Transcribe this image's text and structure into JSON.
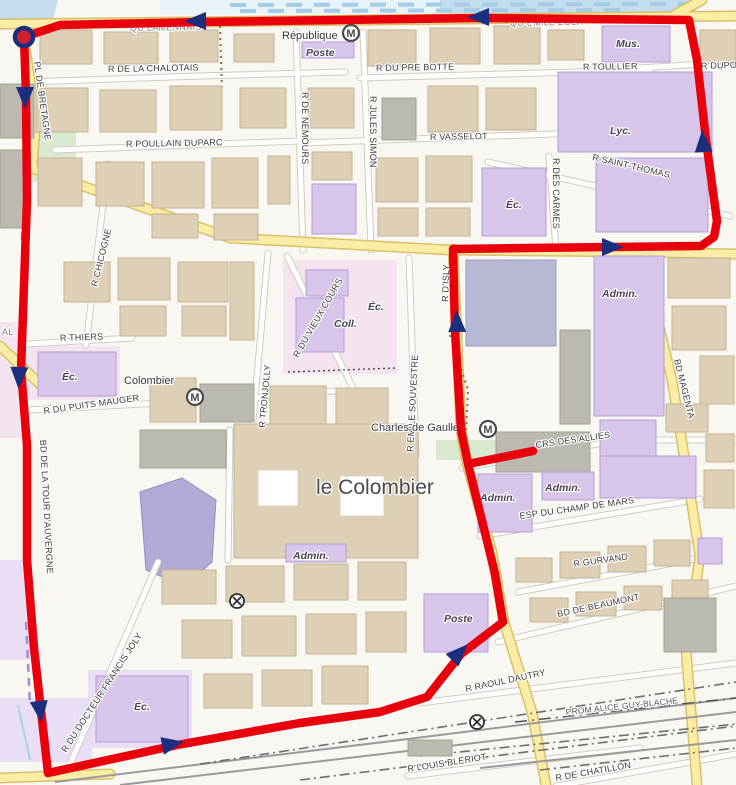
{
  "colors": {
    "route": "#e8000d",
    "arrow": "#1b2f7e",
    "marker_fill": "#d21f2e",
    "water": "#c3dcee",
    "road_yellow": "#fbeda5",
    "building_public": "#d7c6ea"
  },
  "route": {
    "main_points": "533,451 468,464 461,430 455,330 453,249 610,247 701,246 714,237 717,221 706,140 697,60 689,20 480,18 200,22 60,25 24,37 26,95 27,200 21,370 27,445 27,560 34,648 48,773 177,745 300,723 380,712 427,697 461,654 503,622 495,574 489,549 468,464",
    "marker": {
      "x": 24,
      "y": 37
    },
    "arrows": [
      {
        "x": 196,
        "y": 21,
        "a": 180
      },
      {
        "x": 479,
        "y": 17,
        "a": 180
      },
      {
        "x": 703,
        "y": 142,
        "a": -94
      },
      {
        "x": 612,
        "y": 247,
        "a": 0
      },
      {
        "x": 457,
        "y": 322,
        "a": -91
      },
      {
        "x": 25,
        "y": 97,
        "a": 90
      },
      {
        "x": 19,
        "y": 377,
        "a": 92
      },
      {
        "x": 40,
        "y": 711,
        "a": 83
      },
      {
        "x": 172,
        "y": 744,
        "a": -11
      },
      {
        "x": 459,
        "y": 653,
        "a": -46
      }
    ]
  },
  "labels": [
    {
      "t": "QU LAMENNAIS",
      "x": 130,
      "y": 31,
      "r": -1,
      "c": "quay"
    },
    {
      "t": "QU EMILE ZOLA",
      "x": 510,
      "y": 26,
      "r": -1,
      "c": "quay"
    },
    {
      "t": "AL",
      "x": 2,
      "y": 335,
      "r": 0,
      "c": "quay"
    },
    {
      "t": "R DE LA CHALOTAIS",
      "x": 108,
      "y": 72,
      "r": -1,
      "c": "street"
    },
    {
      "t": "R DU PRE BOTTE",
      "x": 376,
      "y": 71,
      "r": -1,
      "c": "street"
    },
    {
      "t": "R TOULLIER",
      "x": 583,
      "y": 70,
      "r": -1,
      "c": "street"
    },
    {
      "t": "R DUPO",
      "x": 701,
      "y": 69,
      "r": -2,
      "c": "street"
    },
    {
      "t": "R POULLAIN DUPARC",
      "x": 126,
      "y": 147,
      "r": -1,
      "c": "street"
    },
    {
      "t": "R VASSELOT",
      "x": 430,
      "y": 140,
      "r": -1,
      "c": "street"
    },
    {
      "t": "R SAINT-THOMAS",
      "x": 592,
      "y": 160,
      "r": 13,
      "c": "street"
    },
    {
      "t": "R DE NEMOURS",
      "x": 302,
      "y": 92,
      "r": 90,
      "c": "street"
    },
    {
      "t": "R JULES SIMON",
      "x": 370,
      "y": 96,
      "r": 90,
      "c": "street"
    },
    {
      "t": "R DES CARMES",
      "x": 553,
      "y": 158,
      "r": 90,
      "c": "street"
    },
    {
      "t": "R CHICOGNE",
      "x": 97,
      "y": 287,
      "r": -76,
      "c": "street"
    },
    {
      "t": "R TRONJOLLY",
      "x": 265,
      "y": 428,
      "r": -85,
      "c": "street"
    },
    {
      "t": "R DU VIEUX COURS",
      "x": 298,
      "y": 358,
      "r": -60,
      "c": "street"
    },
    {
      "t": "R EMILE SOUVESTRE",
      "x": 413,
      "y": 452,
      "r": -87,
      "c": "street"
    },
    {
      "t": "R D'ISLY",
      "x": 448,
      "y": 302,
      "r": -88,
      "c": "street"
    },
    {
      "t": "R THIERS",
      "x": 60,
      "y": 341,
      "r": -2,
      "c": "street"
    },
    {
      "t": "R DU PUITS MAUGER",
      "x": 44,
      "y": 414,
      "r": -8,
      "c": "street"
    },
    {
      "t": "BD DE LA TOUR D'AUVERGNE",
      "x": 40,
      "y": 440,
      "r": 87,
      "c": "street"
    },
    {
      "t": "PL DE BRETAGNE",
      "x": 34,
      "y": 62,
      "r": 82,
      "c": "street"
    },
    {
      "t": "BD MAGENTA",
      "x": 674,
      "y": 360,
      "r": 76,
      "c": "street"
    },
    {
      "t": "CRS DES ALLIES",
      "x": 536,
      "y": 448,
      "r": -8,
      "c": "street"
    },
    {
      "t": "ESP DU CHAMP DE MARS",
      "x": 520,
      "y": 519,
      "r": -8,
      "c": "street"
    },
    {
      "t": "R GURVAND",
      "x": 574,
      "y": 567,
      "r": -8,
      "c": "street"
    },
    {
      "t": "BD DE BEAUMONT",
      "x": 558,
      "y": 617,
      "r": -12,
      "c": "street"
    },
    {
      "t": "R RAOUL DAUTRY",
      "x": 466,
      "y": 692,
      "r": -12,
      "c": "street"
    },
    {
      "t": "PROM ALICE GUY-BLACHE",
      "x": 566,
      "y": 715,
      "r": -6,
      "c": "path"
    },
    {
      "t": "R LOUIS BLERIOT",
      "x": 408,
      "y": 772,
      "r": -9,
      "c": "street"
    },
    {
      "t": "R DE CHATILLON",
      "x": 556,
      "y": 781,
      "r": -10,
      "c": "street"
    },
    {
      "t": "R DU DOCTEUR FRANCIS JOLY",
      "x": 66,
      "y": 753,
      "r": -57,
      "c": "street"
    },
    {
      "t": "République",
      "x": 282,
      "y": 39,
      "r": 0,
      "c": "place"
    },
    {
      "t": "Poste",
      "x": 306,
      "y": 56,
      "r": 0,
      "c": "amen"
    },
    {
      "t": "Colombier",
      "x": 124,
      "y": 384,
      "r": 0,
      "c": "place"
    },
    {
      "t": "Charles de Gaulle",
      "x": 371,
      "y": 431,
      "r": 0,
      "c": "place"
    },
    {
      "t": "le Colombier",
      "x": 316,
      "y": 494,
      "r": 0,
      "c": "bigplace"
    },
    {
      "t": "Mus.",
      "x": 616,
      "y": 47,
      "r": 0,
      "c": "amen"
    },
    {
      "t": "Lyc.",
      "x": 610,
      "y": 134,
      "r": 0,
      "c": "amen"
    },
    {
      "t": "Éc.",
      "x": 506,
      "y": 208,
      "r": 0,
      "c": "amen"
    },
    {
      "t": "Éc.",
      "x": 368,
      "y": 310,
      "r": 0,
      "c": "amen"
    },
    {
      "t": "Coll.",
      "x": 334,
      "y": 327,
      "r": 0,
      "c": "amen"
    },
    {
      "t": "Éc.",
      "x": 62,
      "y": 380,
      "r": 0,
      "c": "amen"
    },
    {
      "t": "Admin.",
      "x": 602,
      "y": 297,
      "r": 0,
      "c": "amen"
    },
    {
      "t": "Admin.",
      "x": 480,
      "y": 501,
      "r": 0,
      "c": "amen"
    },
    {
      "t": "Admin.",
      "x": 545,
      "y": 491,
      "r": 0,
      "c": "amen"
    },
    {
      "t": "Admin.",
      "x": 293,
      "y": 559,
      "r": 0,
      "c": "amen"
    },
    {
      "t": "Poste",
      "x": 444,
      "y": 622,
      "r": 0,
      "c": "amen"
    },
    {
      "t": "Éc.",
      "x": 134,
      "y": 710,
      "r": 0,
      "c": "amen"
    }
  ],
  "metro_stations": [
    {
      "x": 351,
      "y": 33
    },
    {
      "x": 195,
      "y": 397
    },
    {
      "x": 488,
      "y": 429
    }
  ],
  "crossings": [
    {
      "x": 237,
      "y": 601
    },
    {
      "x": 477,
      "y": 722
    }
  ]
}
